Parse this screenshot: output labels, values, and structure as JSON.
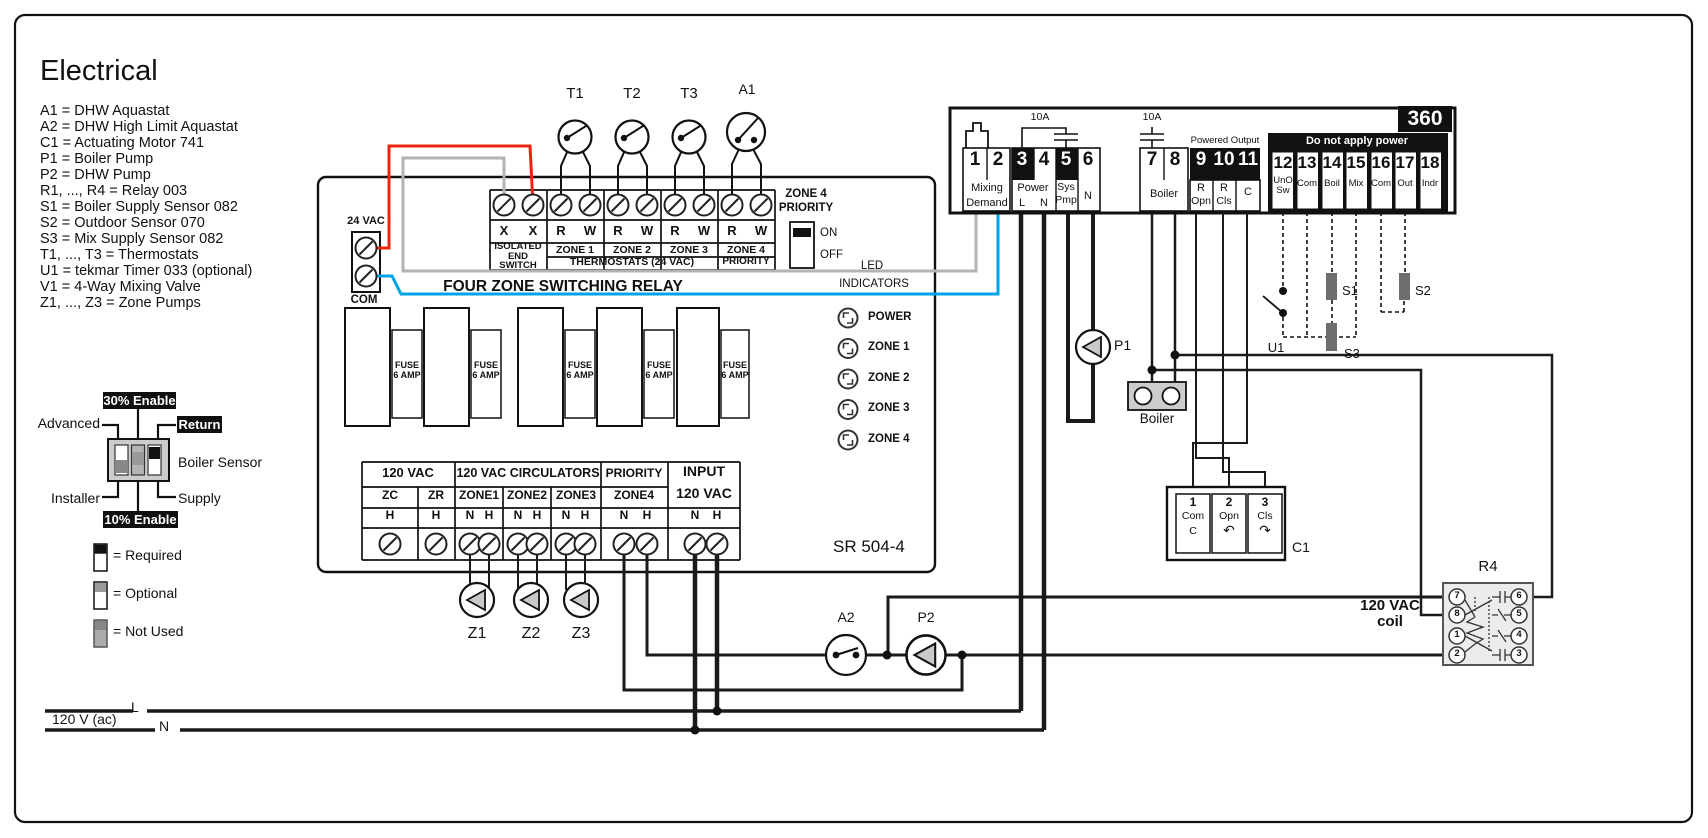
{
  "legend": {
    "title": "Electrical",
    "items": [
      "A1 = DHW Aquastat",
      "A2 = DHW High Limit Aquastat",
      "C1 = Actuating Motor 741",
      "P1 = Boiler Pump",
      "P2 = DHW Pump",
      "R1, ..., R4 = Relay 003",
      "S1 = Boiler Supply Sensor 082",
      "S2 = Outdoor Sensor 070",
      "S3 = Mix Supply Sensor 082",
      "T1, ..., T3 = Thermostats",
      "U1 = tekmar Timer 033 (optional)",
      "V1 = 4-Way Mixing Valve",
      "Z1, ..., Z3 = Zone Pumps"
    ]
  },
  "dip": {
    "enable30": "30% Enable",
    "advanced": "Advanced",
    "return_label": "Return",
    "boiler_sensor": "Boiler Sensor",
    "installer": "Installer",
    "supply": "Supply",
    "enable10": "10% Enable",
    "required": "= Required",
    "optional": "= Optional",
    "not_used": "= Not Used"
  },
  "mains": {
    "label": "120 V (ac)",
    "l": "L",
    "n": "N"
  },
  "sr": {
    "title": "FOUR ZONE SWITCHING RELAY",
    "model": "SR 504-4",
    "vac24": "24 VAC",
    "com": "COM",
    "top_strip": {
      "letters": [
        "X",
        "X",
        "R",
        "W",
        "R",
        "W",
        "R",
        "W",
        "R",
        "W"
      ],
      "isolated": "ISOLATED\nEND\nSWITCH",
      "zones": [
        "ZONE 1",
        "ZONE 2",
        "ZONE 3",
        "ZONE 4"
      ],
      "thermostats": "THERMOSTATS (24 VAC)",
      "priority": "PRIORITY"
    },
    "priority_switch": {
      "line1": "ZONE 4",
      "line2": "PRIORITY",
      "on": "ON",
      "off": "OFF"
    },
    "led": {
      "heading1": "LED",
      "heading2": "INDICATORS",
      "items": [
        "POWER",
        "ZONE 1",
        "ZONE 2",
        "ZONE 3",
        "ZONE 4"
      ]
    },
    "fuse": "FUSE\n6 AMP",
    "bottom_strip": {
      "h_120vac": "120 VAC",
      "h_circ": "120 VAC CIRCULATORS",
      "h_priority": "PRIORITY",
      "h_input": "INPUT",
      "h_input2": "120 VAC",
      "cols": [
        "ZC",
        "ZR",
        "ZONE1",
        "ZONE2",
        "ZONE3",
        "ZONE4"
      ],
      "letters": [
        "H",
        "H",
        "N",
        "H",
        "N",
        "H",
        "N",
        "H",
        "N",
        "H",
        "N",
        "H"
      ]
    }
  },
  "t360": {
    "badge": "360",
    "fuse1": "10A",
    "fuse2": "10A",
    "powered_output": "Powered Output",
    "no_power": "Do not apply power",
    "terms": [
      "1",
      "2",
      "3",
      "4",
      "5",
      "6",
      "7",
      "8",
      "9",
      "10",
      "11",
      "12",
      "13",
      "14",
      "15",
      "16",
      "17",
      "18"
    ],
    "mixing": "Mixing",
    "demand": "Demand",
    "power": "Power",
    "l": "L",
    "n": "N",
    "sys": "Sys",
    "pmp": "Pmp",
    "n2": "N",
    "boiler": "Boiler",
    "r1": "R",
    "opn": "Opn",
    "r2": "R",
    "cls": "Cls",
    "c": "C",
    "t12": "UnO\nSw",
    "t13": "Com",
    "t14": "Boil",
    "t15": "Mix",
    "t16": "Com",
    "t17": "Out",
    "t18": "Indr"
  },
  "devices": {
    "t1": "T1",
    "t2": "T2",
    "t3": "T3",
    "a1": "A1",
    "a2": "A2",
    "p1": "P1",
    "p2": "P2",
    "z1": "Z1",
    "z2": "Z2",
    "z3": "Z3",
    "u1": "U1",
    "s1": "S1",
    "s2": "S2",
    "s3": "S3",
    "boiler": "Boiler",
    "r4": "R4",
    "coil": "120 VAC\ncoil",
    "c1": "C1"
  },
  "c1": {
    "n1": "1",
    "com": "Com",
    "c": "C",
    "n2": "2",
    "opn": "Opn",
    "opn_arrow": "↶",
    "n3": "3",
    "cls": "Cls",
    "cls_arrow": "↷"
  },
  "r4_terms": {
    "left": [
      "7",
      "8",
      "1",
      "2"
    ],
    "right": [
      "6",
      "5",
      "4",
      "3"
    ]
  },
  "colors": {
    "wire_red": "#e8250f",
    "wire_blue": "#00a2e8",
    "wire_gray": "#b3b3b3"
  }
}
